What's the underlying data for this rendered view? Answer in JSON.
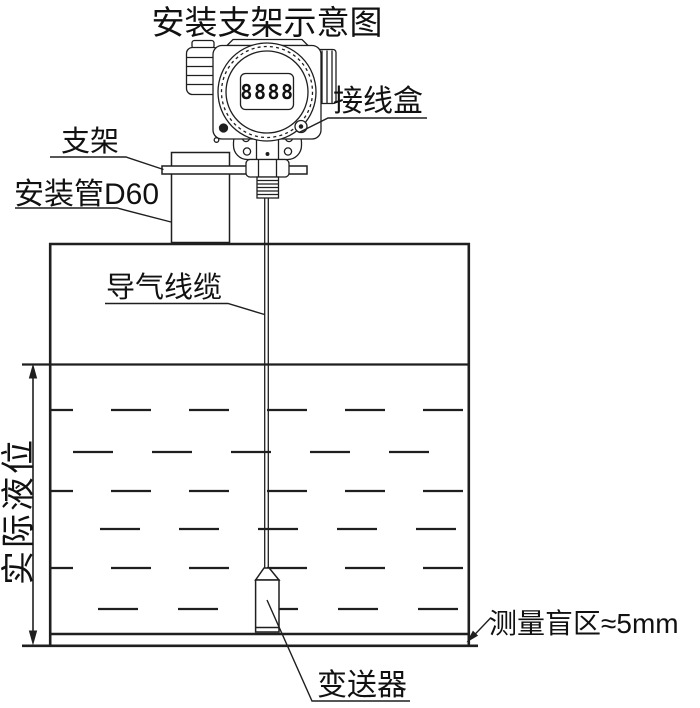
{
  "title": "安装支架示意图",
  "colors": {
    "line": "#1f1f1f",
    "text": "#111111",
    "background": "#ffffff"
  },
  "device": {
    "lcd_reading": "8888"
  },
  "labels": {
    "junction_box": "接线盒",
    "bracket": "支架",
    "mounting_pipe": "安装管D60",
    "air_cable": "导气线缆",
    "actual_level": "实际液位",
    "blind_zone": "测量盲区≈5mm",
    "transmitter": "变送器"
  }
}
